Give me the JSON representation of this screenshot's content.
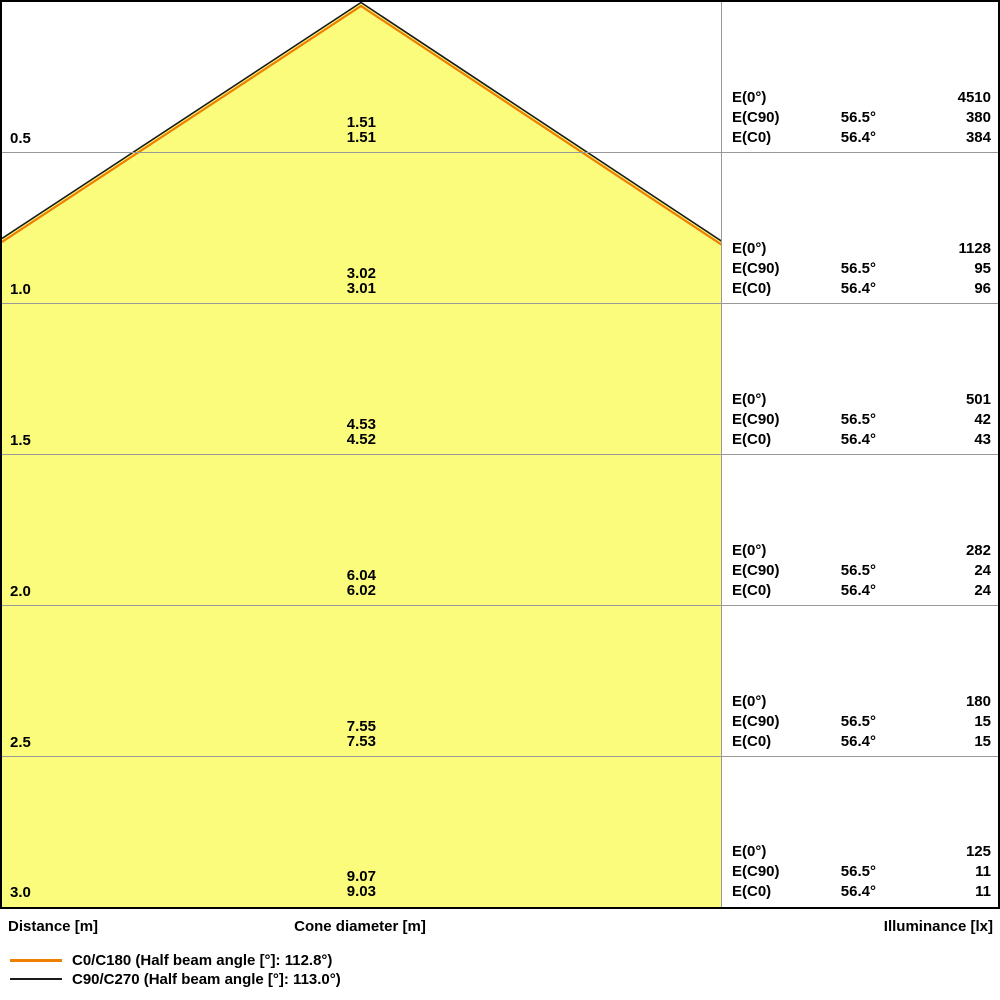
{
  "chart_data": {
    "type": "area",
    "title": "Light cone diagram",
    "distance_axis_label": "Distance [m]",
    "cone_diameter_axis_label": "Cone diameter [m]",
    "illuminance_axis_label": "Illuminance [lx]",
    "labels": {
      "e0": "E(0°)",
      "ec90": "E(C90)",
      "ec0": "E(C0)"
    },
    "rows": [
      {
        "distance": "0.5",
        "dia_c90": "1.51",
        "dia_c0": "1.51",
        "e0": "4510",
        "ec90_angle": "56.5°",
        "ec90": "380",
        "ec0_angle": "56.4°",
        "ec0": "384"
      },
      {
        "distance": "1.0",
        "dia_c90": "3.02",
        "dia_c0": "3.01",
        "e0": "1128",
        "ec90_angle": "56.5°",
        "ec90": "95",
        "ec0_angle": "56.4°",
        "ec0": "96"
      },
      {
        "distance": "1.5",
        "dia_c90": "4.53",
        "dia_c0": "4.52",
        "e0": "501",
        "ec90_angle": "56.5°",
        "ec90": "42",
        "ec0_angle": "56.4°",
        "ec0": "43"
      },
      {
        "distance": "2.0",
        "dia_c90": "6.04",
        "dia_c0": "6.02",
        "e0": "282",
        "ec90_angle": "56.5°",
        "ec90": "24",
        "ec0_angle": "56.4°",
        "ec0": "24"
      },
      {
        "distance": "2.5",
        "dia_c90": "7.55",
        "dia_c0": "7.53",
        "e0": "180",
        "ec90_angle": "56.5°",
        "ec90": "15",
        "ec0_angle": "56.4°",
        "ec0": "15"
      },
      {
        "distance": "3.0",
        "dia_c90": "9.07",
        "dia_c0": "9.03",
        "e0": "125",
        "ec90_angle": "56.5°",
        "ec90": "11",
        "ec0_angle": "56.4°",
        "ec0": "11"
      }
    ],
    "legend": [
      {
        "label": "C0/C180 (Half beam angle [°]: 112.8°)",
        "color": "#EE7F00"
      },
      {
        "label": "C90/C270 (Half beam angle [°]: 113.0°)",
        "color": "#1A1A1A"
      }
    ],
    "colors": {
      "cone_fill": "#FCFC7C",
      "grid": "#999999",
      "c0_line": "#EE7F00",
      "c90_line": "#1A1A1A"
    },
    "layout": {
      "half_beam_angles_deg": [
        112.8,
        113.0
      ],
      "grid": "on",
      "legend_position": "bottom-left"
    }
  }
}
